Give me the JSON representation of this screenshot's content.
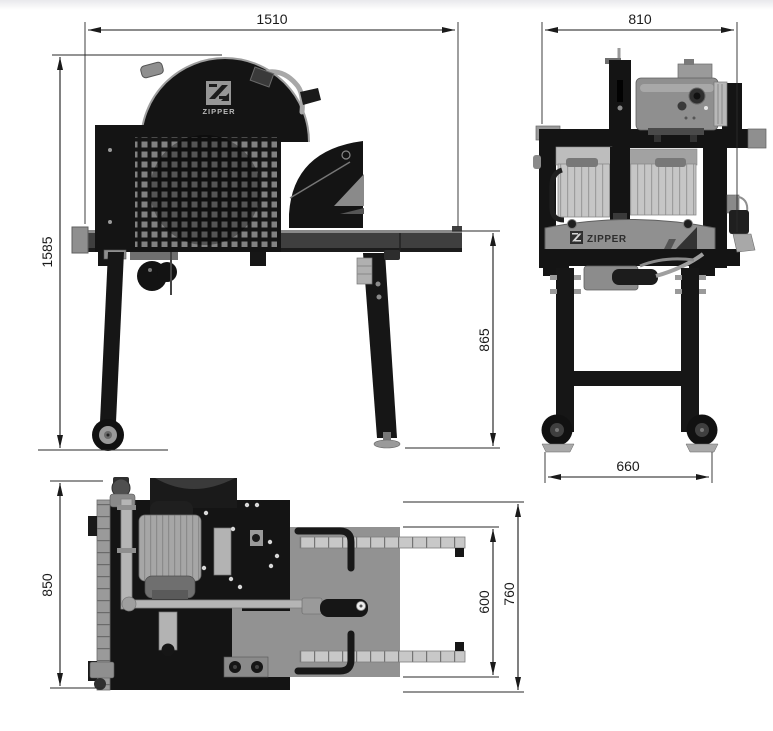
{
  "drawing": {
    "brand": "ZIPPER",
    "views": {
      "side": {
        "width_mm": "1510",
        "total_height_mm": "1585",
        "table_height_mm": "865"
      },
      "front": {
        "width_mm": "810",
        "track_mm": "660"
      },
      "top": {
        "depth_mm": "850",
        "rail_span_mm": "600",
        "table_depth_mm": "760"
      }
    },
    "colors": {
      "dimension_line": "#1a1a1a",
      "machine_dark": "#151515",
      "machine_gray": "#8f8f8f",
      "machine_light_gray": "#c4c4c4",
      "background": "#ffffff"
    }
  }
}
